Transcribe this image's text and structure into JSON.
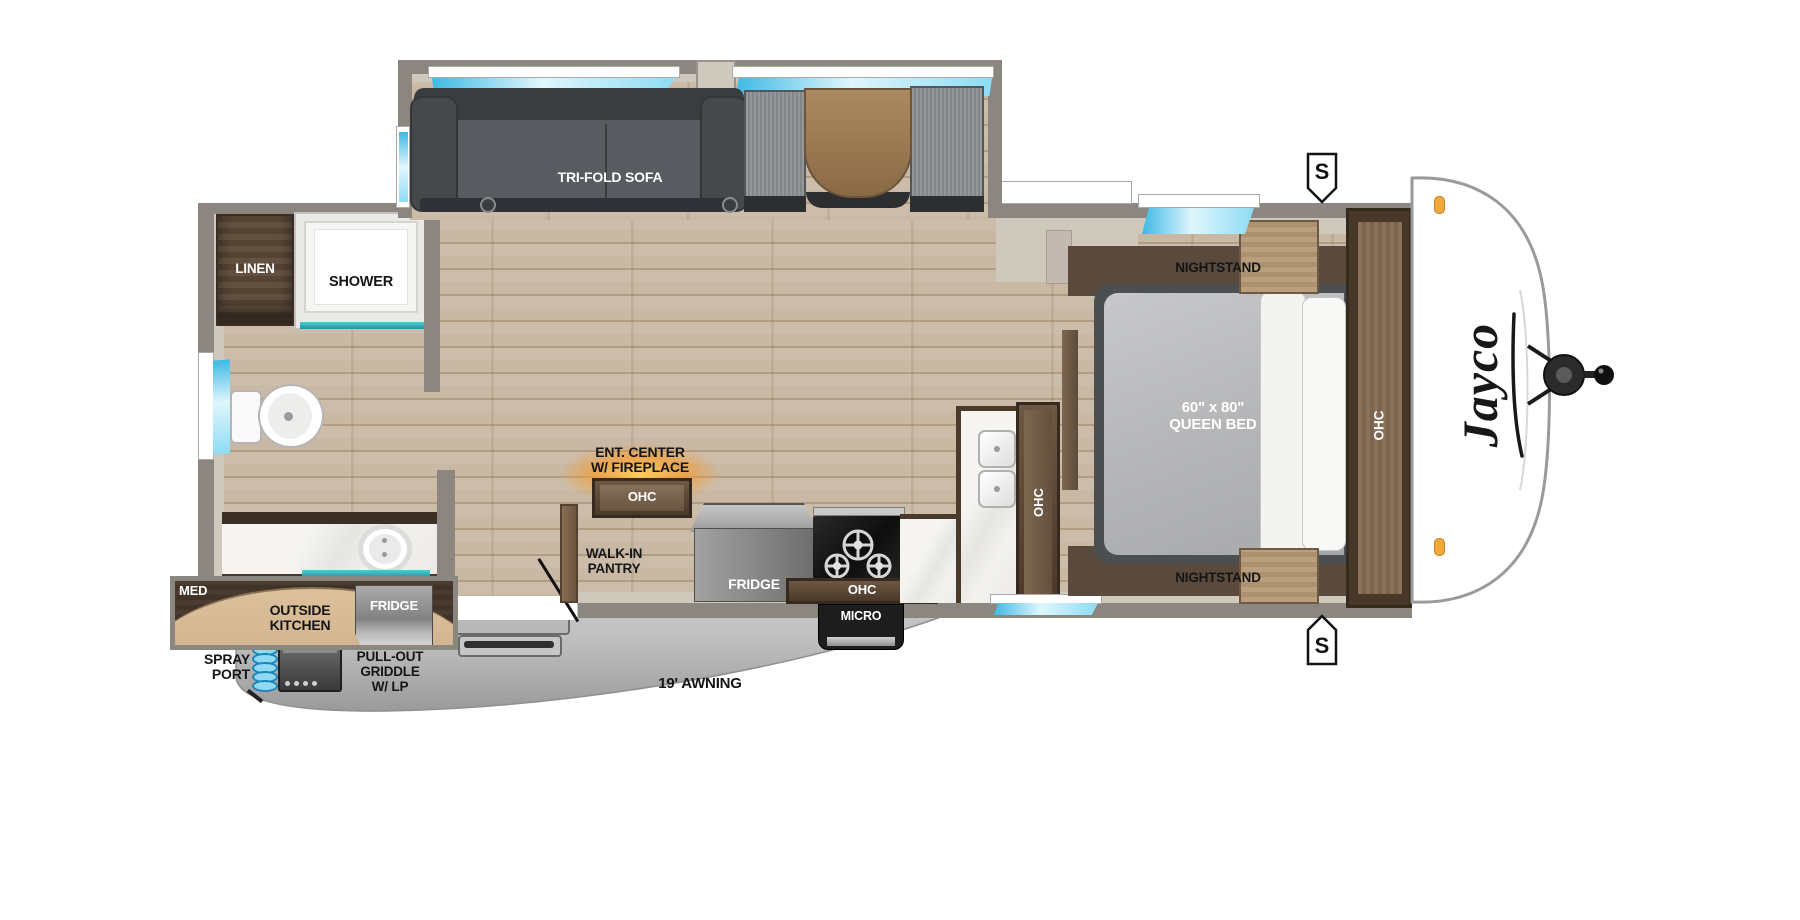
{
  "labels": {
    "sofa": "TRI-FOLD SOFA",
    "linen": "LINEN",
    "shower": "SHOWER",
    "ent_center_1": "ENT. CENTER",
    "ent_center_2": "W/ FIREPLACE",
    "ent_center_ohc": "OHC",
    "pantry_1": "WALK-IN",
    "pantry_2": "PANTRY",
    "fridge": "FRIDGE",
    "micro": "MICRO",
    "kitchen_ohc_bottom": "OHC",
    "kitchen_ohc_side": "OHC",
    "nightstand_top": "NIGHTSTAND",
    "nightstand_bottom": "NIGHTSTAND",
    "bed_size": "60\" x 80\"",
    "bed_type": "QUEEN BED",
    "bedroom_ohc": "OHC",
    "med": "MED",
    "outside_kitchen_1": "OUTSIDE",
    "outside_kitchen_2": "KITCHEN",
    "outside_fridge": "FRIDGE",
    "spray_1": "SPRAY",
    "spray_2": "PORT",
    "griddle_1": "PULL-OUT",
    "griddle_2": "GRIDDLE",
    "griddle_3": "W/ LP",
    "awning": "19' AWNING",
    "brand": "Jayco",
    "safety_top": "S",
    "safety_bottom": "S"
  },
  "colors": {
    "window_blue": "#8edcf4",
    "teal_accent": "#2ab5b5",
    "fireplace_glow": "#f59b2d",
    "marker_amber": "#f0a93c",
    "floor_wood": "#c8b8a4",
    "cabinet_walnut": "#5c4836",
    "wall_gray": "#8b8680"
  }
}
